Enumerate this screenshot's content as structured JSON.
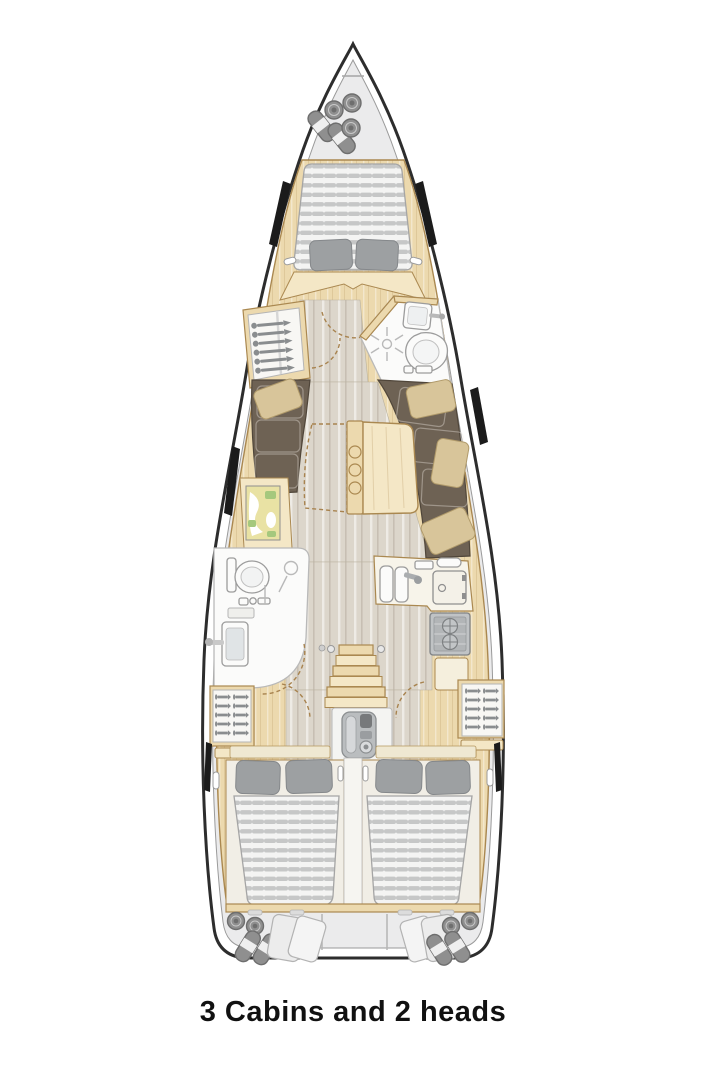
{
  "page": {
    "background": "#ffffff"
  },
  "caption": {
    "text": "3 Cabins and 2 heads"
  },
  "colors": {
    "hull_stroke": "#2d2d2d",
    "hull_fill": "#ffffff",
    "deck": "#ebebec",
    "deck_stroke": "#9a9a9a",
    "wood": "#ecd9ae",
    "wood_stroke": "#aa8850",
    "wood_light": "#f4e7c6",
    "floor": "#dcd6cb",
    "mattress_base": "#f4f4f3",
    "mattress_stripe": "#c6c7c7",
    "mattress_stroke": "#a5a5a5",
    "pillow": "#9da0a2",
    "sofa": "#6e6254",
    "sofa_stroke": "#50463a",
    "cushion": "#d8c59a",
    "cushion_stroke": "#b09a6a",
    "fixture": "#fbfbfa",
    "fixture_stroke": "#9c9c9c",
    "metal": "#c0c3c5",
    "metal_dark": "#8a8d8f",
    "fender": "#8f8f8f",
    "window": "#1b1b1b",
    "map_sand": "#e9e2a4",
    "map_green": "#a5c87d",
    "caption_color": "#111111"
  },
  "plan": {
    "type": "sailing-yacht-interior-layout",
    "cabins": 3,
    "heads": 2,
    "areas": [
      "bow-fender-locker",
      "v-berth-owner-cabin",
      "port-hanging-locker",
      "forward-head",
      "saloon-port-sofa",
      "nav-chart-table",
      "saloon-folding-table",
      "saloon-starboard-sofa",
      "aft-head",
      "galley",
      "companionway-steps",
      "engine-compartment",
      "port-aft-cabin",
      "starboard-aft-cabin",
      "stern-lazarette"
    ]
  }
}
